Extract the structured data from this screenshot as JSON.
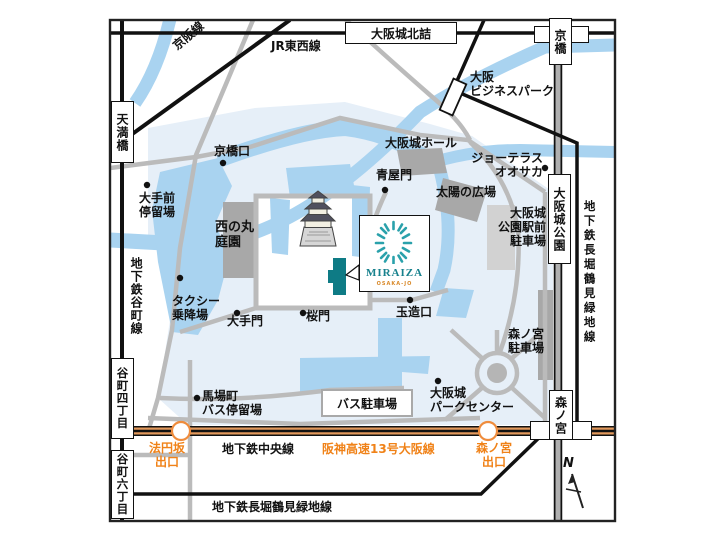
{
  "map": {
    "title": "MIRAIZA OSAKA-JO access map (Osaka Castle area)",
    "colors": {
      "water": "#a9d3f0",
      "park": "#e6eff8",
      "road": "#bbbbbb",
      "building": "#a8a8a8",
      "expressway_orange": "#e2995c",
      "orange_text": "#f08218",
      "miraiza_teal": "#0e7b85",
      "logo_teal": "#2aa1ab"
    },
    "stations": {
      "osakajo_kitazume": "大阪城北詰",
      "kyobashi": "京橋",
      "temmabashi": "天満橋",
      "tanimachi_4chome": "谷町四丁目",
      "tanimachi_6chome": "谷町六丁目",
      "osakajo_koen": "大阪城公園",
      "morinomiya": "森ノ宮"
    },
    "lines": {
      "keihan": "京阪線",
      "jr_tozai": "JR東西線",
      "tanimachi_subway": "地下鉄谷町線",
      "nagahori_right": "地下鉄長堀鶴見緑地線",
      "nagahori_bottom": "地下鉄長堀鶴見緑地線",
      "chuo_subway": "地下鉄中央線",
      "hanshin_expressway": "阪神高速13号大阪線"
    },
    "exits": {
      "hoenzaka": "法円坂\n出口",
      "morinomiya": "森ノ宮\n出口"
    },
    "pois": {
      "kyobashi_guchi": "京橋口",
      "aoyamon": "青屋門",
      "otemae_teiryujo": "大手前\n停留場",
      "nishinomaru_teien": "西の丸\n庭園",
      "taxi_noriba": "タクシー\n乗降場",
      "otemon": "大手門",
      "sakuramon": "桜門",
      "tamatsukuri_guchi": "玉造口",
      "osakajo_hall": "大阪城ホール",
      "jo_terrace": "ジョーテラス\nオオサカ",
      "taiyo_no_hiroba": "太陽の広場",
      "koen_ekimae_parking": "大阪城\n公園駅前\n駐車場",
      "obp": "大阪\nビジネスパーク",
      "morinomiya_parking": "森ノ宮\n駐車場",
      "babacho_bus_stop": "馬場町\nバス停留場",
      "bus_parking": "バス駐車場",
      "park_center": "大阪城\nパークセンター"
    },
    "logo": {
      "name": "MIRAIZA",
      "subtitle": "OSAKA-JO"
    },
    "compass": {
      "label": "N"
    }
  }
}
